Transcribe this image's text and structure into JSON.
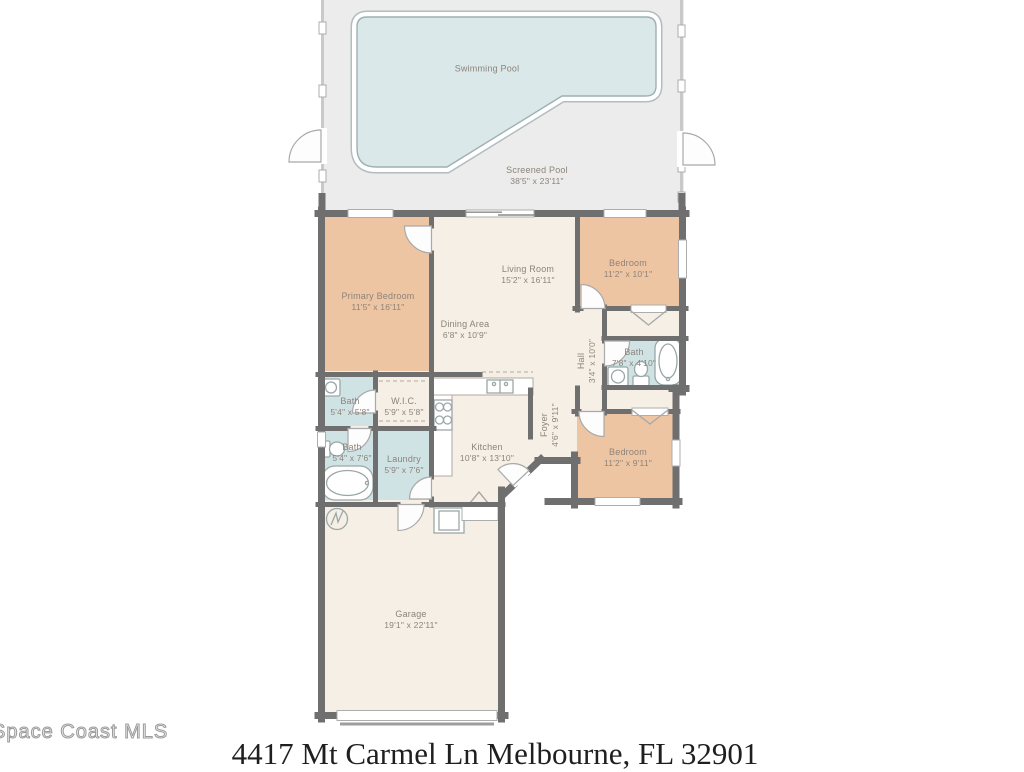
{
  "footer": {
    "address": "4417 Mt Carmel Ln Melbourne, FL 32901",
    "watermark": "Space Coast MLS"
  },
  "rooms": [
    {
      "id": "swimming-pool",
      "name": "Swimming Pool",
      "dims": ""
    },
    {
      "id": "screened-pool",
      "name": "Screened Pool",
      "dims": "38'5\" x 23'11\""
    },
    {
      "id": "primary-bedroom",
      "name": "Primary Bedroom",
      "dims": "11'5\" x 16'11\""
    },
    {
      "id": "living-room",
      "name": "Living Room",
      "dims": "15'2\" x 16'11\""
    },
    {
      "id": "bedroom-1",
      "name": "Bedroom",
      "dims": "11'2\" x 10'1\""
    },
    {
      "id": "dining-area",
      "name": "Dining Area",
      "dims": "6'8\" x 10'9\""
    },
    {
      "id": "hall",
      "name": "Hall",
      "dims": "3'4\" x 10'0\""
    },
    {
      "id": "bath-hall",
      "name": "Bath",
      "dims": "7'8\" x 4'10\""
    },
    {
      "id": "bath-primary",
      "name": "Bath",
      "dims": "5'4\" x 5'8\""
    },
    {
      "id": "wic",
      "name": "W.I.C.",
      "dims": "5'9\" x 5'8\""
    },
    {
      "id": "bath-2",
      "name": "Bath",
      "dims": "5'4\" x 7'6\""
    },
    {
      "id": "laundry",
      "name": "Laundry",
      "dims": "5'9\" x 7'6\""
    },
    {
      "id": "kitchen",
      "name": "Kitchen",
      "dims": "10'8\" x 13'10\""
    },
    {
      "id": "foyer",
      "name": "Foyer",
      "dims": "4'6\" x 9'11\""
    },
    {
      "id": "bedroom-2",
      "name": "Bedroom",
      "dims": "11'2\" x 9'11\""
    },
    {
      "id": "garage",
      "name": "Garage",
      "dims": "19'1\" x 22'11\""
    }
  ],
  "colors": {
    "wall": "#6f6f6f",
    "cream": "#f6efe6",
    "tan": "#eec5a3",
    "blue": "#cfe3e5",
    "water": "#dae8ea",
    "deck": "#ececec",
    "label": "#8d8379",
    "address": "#1f1f1f",
    "watermark": "#9b9b9b"
  }
}
